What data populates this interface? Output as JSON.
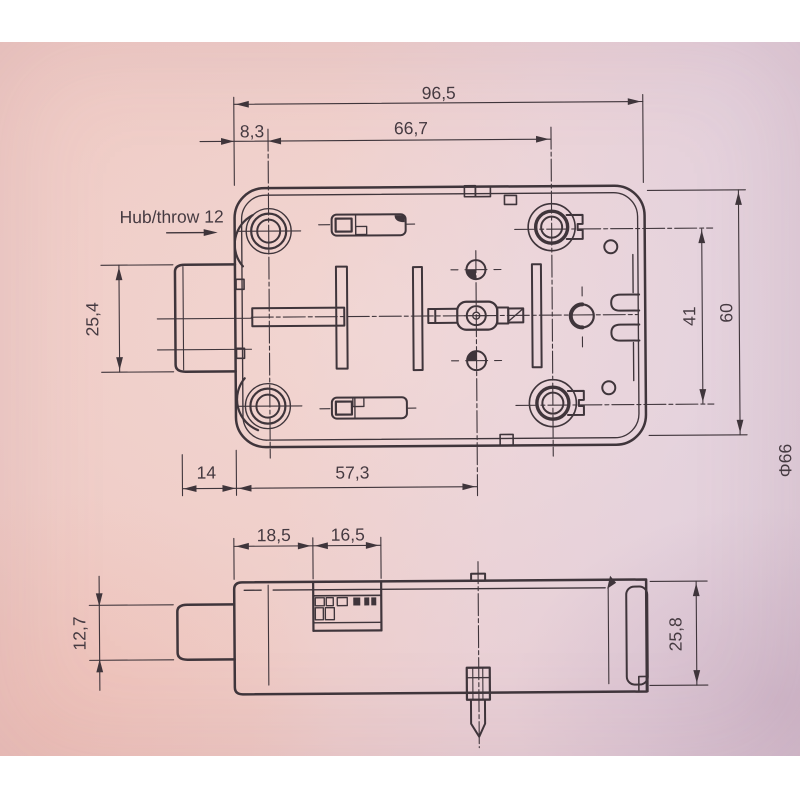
{
  "colors": {
    "paper_pink": "#eecbc6",
    "paper_lavender": "#e3cfda",
    "background_white": "#ffffff",
    "line_color": "#3f353b",
    "text_color": "#453a41"
  },
  "top_view": {
    "dim_total_width": "96,5",
    "dim_edge_to_hole": "8,3",
    "dim_hole_span": "66,7",
    "label_throw": "Hub/throw 12",
    "dim_bolt_height": "25,4",
    "dim_hole_span_vertical": "41",
    "dim_total_height": "60",
    "dim_bolt_protrusion": "14",
    "dim_edge_to_spindle": "57,3"
  },
  "side_view": {
    "dim_edge_to_block": "18,5",
    "dim_block_width": "16,5",
    "dim_bolt_thickness": "12,7",
    "dim_case_depth": "25,8",
    "annotation_diameter": "Φ66"
  }
}
